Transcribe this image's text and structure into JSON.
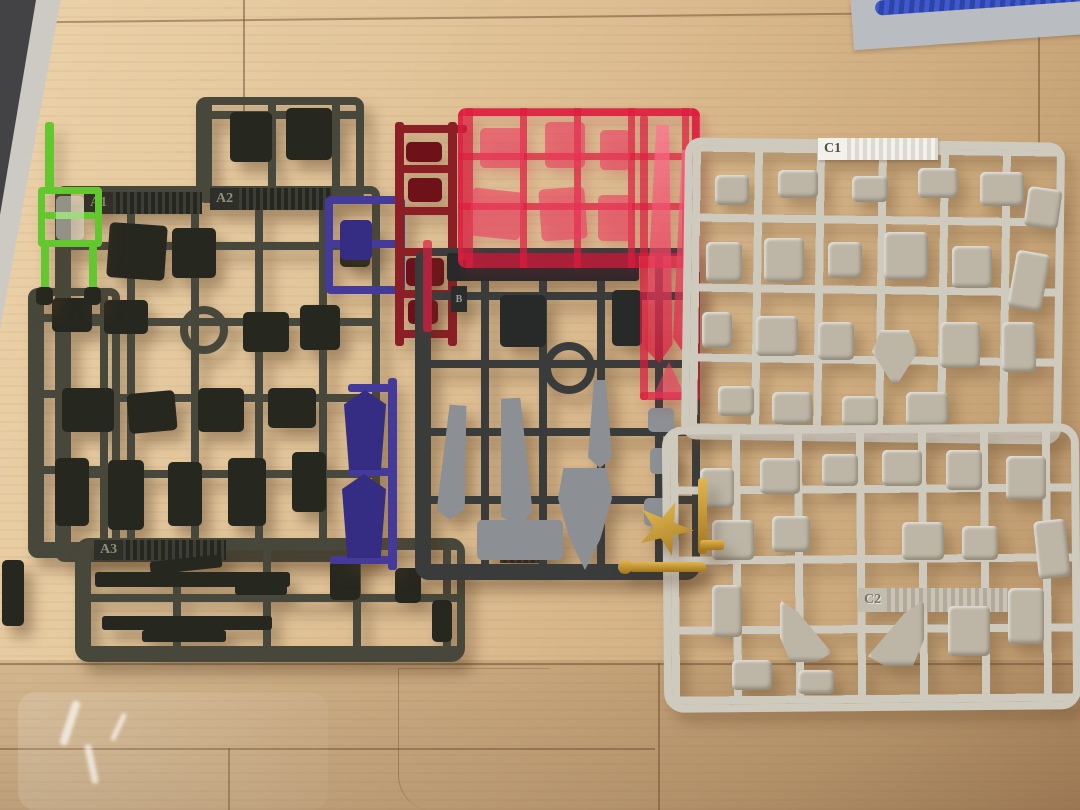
{
  "scene": {
    "description": "Photo of plastic model-kit part runners (sprues) laid out on a light wooden floor",
    "items": [
      "dark olive runners A1/A2/A3",
      "dark gray runner B with silver weapon parts",
      "clear red runner",
      "solid dark red runner",
      "light gray runners C1/C2",
      "small green runner",
      "blue runner with foot parts",
      "gold runner with burst part",
      "gray mat with blue strap at top right",
      "transparent plastic bag at bottom left"
    ]
  },
  "labels": {
    "a1": "A1",
    "a2": "A2",
    "a3": "A3",
    "b": "B",
    "c1": "C1",
    "c2": "C2"
  },
  "palette": {
    "a_frame": "#47483b",
    "a_part": "#26271f",
    "b_frame": "#3a3c3c",
    "b_part": "#8c9095",
    "b_dark": "#282929",
    "c_frame": "#cfcabe",
    "c_part": "#bdb6a7",
    "green": "#63c72f",
    "blue": "#443a99",
    "blue_part": "#352c83",
    "dark_red": "#8c1f26",
    "dark_red_part": "#6e1118",
    "clear_red": "rgba(221,28,62,0.70)",
    "clear_red_part": "rgba(235,60,95,0.60)",
    "clear_red_hi": "rgba(255,115,145,0.72)",
    "gold": "#c9992c",
    "gold_dark": "#a1761c",
    "mat_gray": "#b9bcc0",
    "strap_blue": "#3f59cb",
    "floor_light": "#e8cda3",
    "floor_dark": "#b9946a"
  }
}
